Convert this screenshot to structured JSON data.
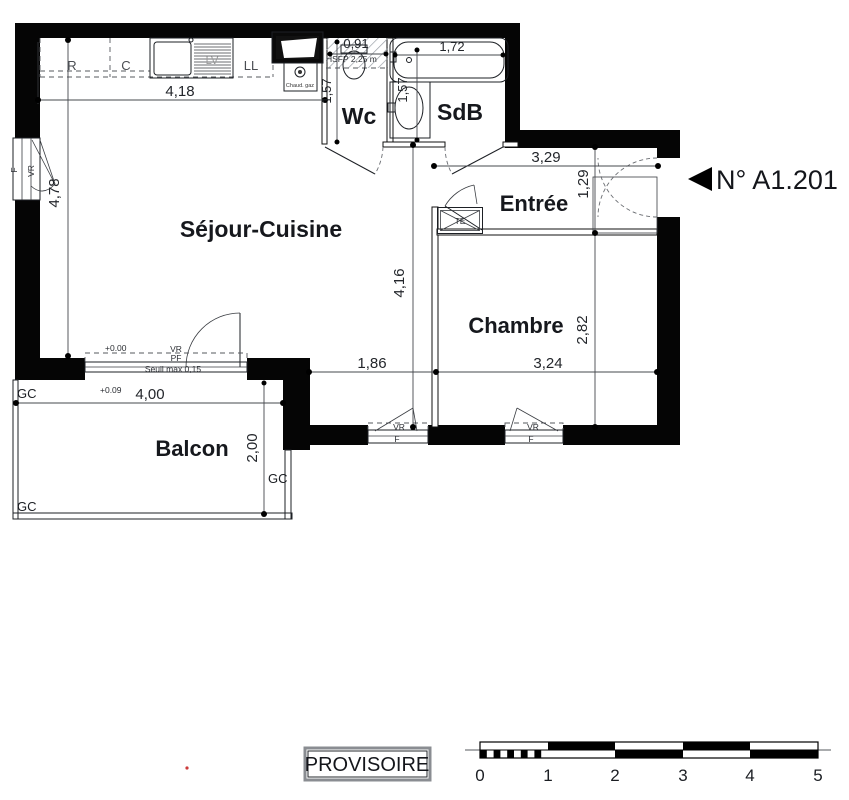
{
  "title_block": {
    "unit_number": "N° A1.201",
    "status": "PROVISOIRE"
  },
  "rooms": {
    "sejour": "Séjour-Cuisine",
    "wc": "Wc",
    "sdb": "SdB",
    "entree": "Entrée",
    "chambre": "Chambre",
    "balcon": "Balcon"
  },
  "dimensions": {
    "kitchen_width": "4,18",
    "sejour_height": "4,78",
    "wc_width": "0,91",
    "wc_depth": "1,57",
    "sdb_depth": "1,57",
    "bath_length": "1,72",
    "entree_width": "3,29",
    "entree_depth": "1,29",
    "sejour_depth": "4,16",
    "chambre_height": "2,82",
    "chambre_width": "3,24",
    "window_offset": "1,86",
    "balcon_width": "4,00",
    "balcon_depth": "2,00"
  },
  "levels": {
    "interior": "+0.00",
    "balcony": "+0.09",
    "seuil": "Seuil max 0,15",
    "hsfp": "HSFP 2,25 m"
  },
  "equipment": {
    "fridge": "R",
    "hob": "C",
    "dishwasher": "LV",
    "washer": "LL",
    "boiler": "Chaud. gaz",
    "closet": "TE"
  },
  "openings": {
    "window": "F",
    "shutter": "VR",
    "french_door": "PF"
  },
  "balcony_marks": {
    "gc": "GC"
  },
  "scale_bar": {
    "ticks": [
      "0",
      "1",
      "2",
      "3",
      "4",
      "5"
    ]
  }
}
